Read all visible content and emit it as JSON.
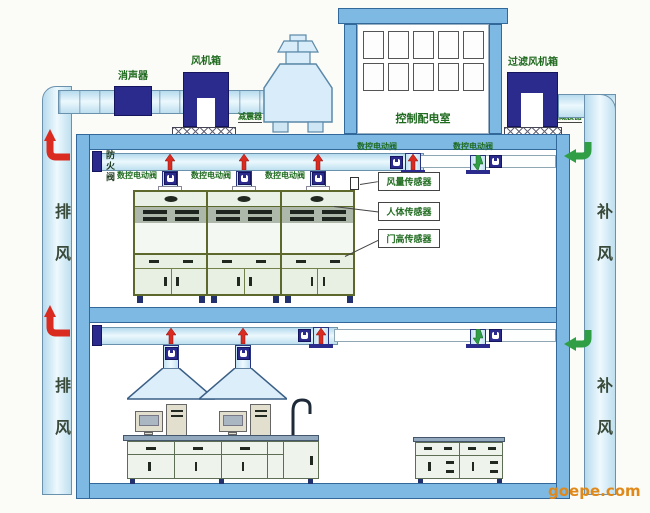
{
  "labels": {
    "silencer": "消声器",
    "fan_box": "风机箱",
    "shock_absorber": "减震器",
    "control_room": "控制配电室",
    "filter_fan_box": "过滤风机箱",
    "fire_damper": "防火阀",
    "cnc_valve": "数控电动阀",
    "exhaust_air": "排风",
    "supply_air": "补风",
    "airflow_sensor": "风量传感器",
    "human_sensor": "人体传感器",
    "door_sensor": "门高传感器",
    "watermark": "goepe.com"
  },
  "colors": {
    "duct_blue": "#cfe9f6",
    "slab_blue": "#7db9e2",
    "equipment_navy": "#2b2b8e",
    "label_green": "#1e6a1e",
    "exhaust_red": "#d92b20",
    "supply_green": "#2f9e44",
    "watermark_orange": "#e08818"
  }
}
